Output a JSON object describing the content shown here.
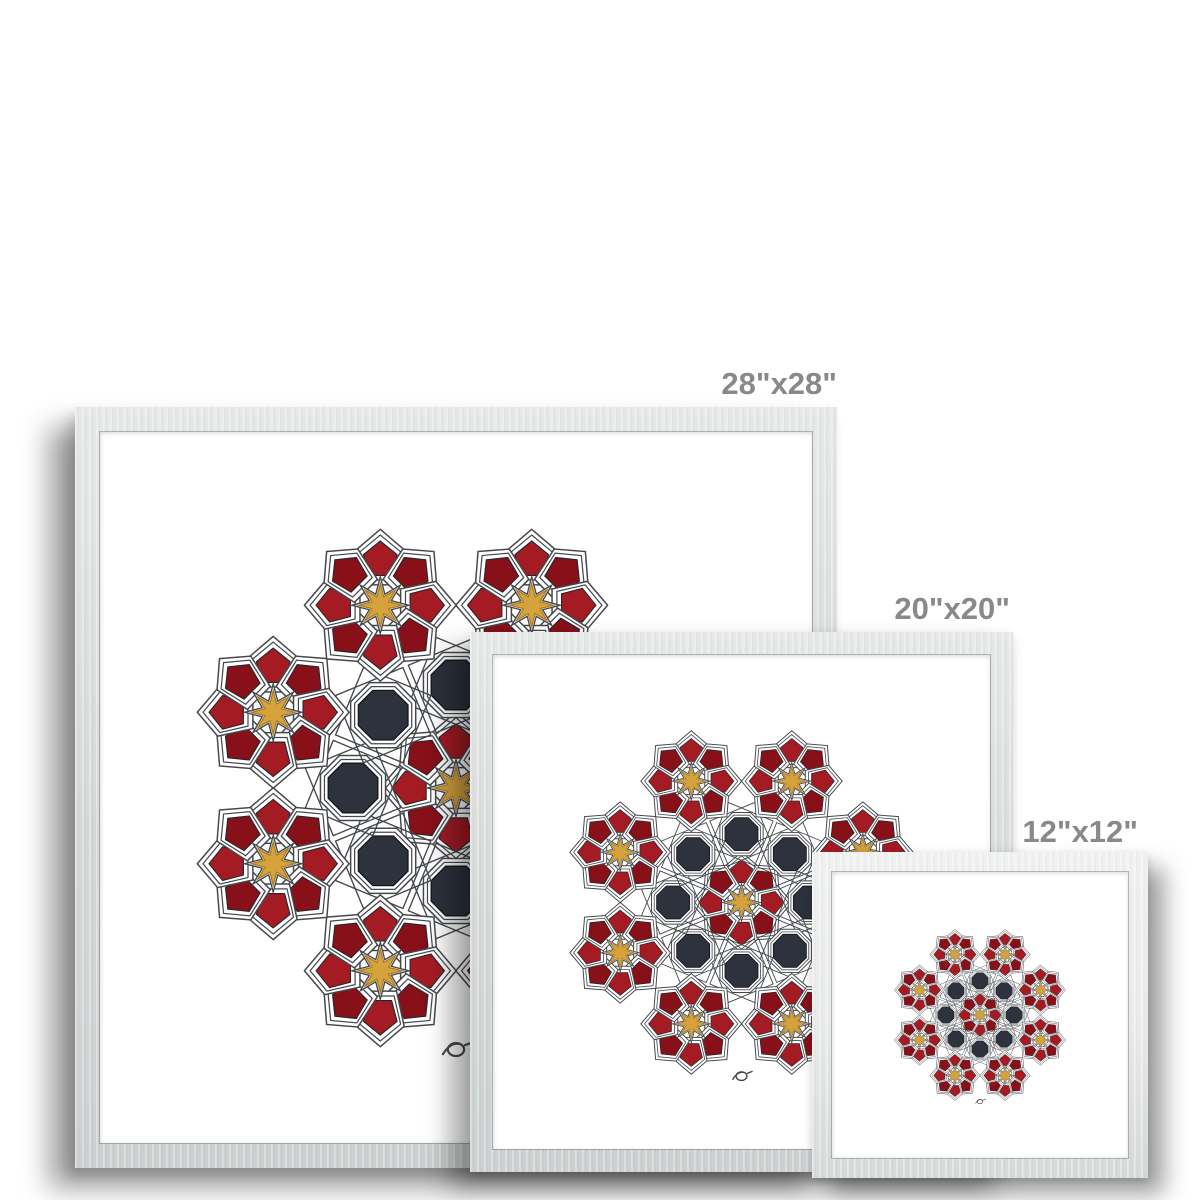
{
  "page": {
    "background": "#ffffff"
  },
  "product_gallery": {
    "sizes": [
      {
        "id": "28x28",
        "label": "28\"x28\""
      },
      {
        "id": "20x20",
        "label": "20\"x20\""
      },
      {
        "id": "12x12",
        "label": "12\"x12\""
      }
    ]
  },
  "artwork": {
    "name": "islamic-geometric-rosette-print",
    "colors": {
      "label_text": "#87898c",
      "frame_gray": "#d6d8d8",
      "frame_gray_light": "#e9eaea",
      "mat_white": "#ffffff",
      "red_bright": "#a51b24",
      "red_dark": "#871019",
      "gold": "#d5a23c",
      "charcoal": "#2d323c",
      "line": "#44484d"
    }
  }
}
